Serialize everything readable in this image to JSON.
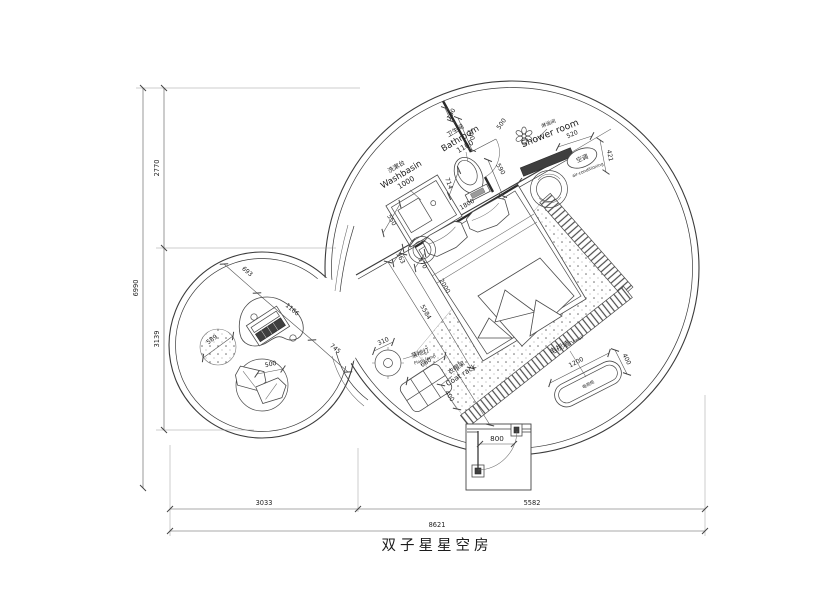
{
  "title": "双子星星空房",
  "labels": {
    "washbasin": {
      "cn": "洗漱台",
      "en": "Washbasin",
      "width": "1000"
    },
    "bathroom": {
      "cn": "卫生间",
      "en": "Bathroom",
      "width": "1100"
    },
    "shower_room": {
      "cn": "淋浴间",
      "en": "Shower room"
    },
    "air_conditioning": {
      "cn": "空调",
      "en": "air-conditioning"
    },
    "floor_lamp": {
      "cn": "落地灯",
      "en": "Floor lamp",
      "diameter": "310"
    },
    "coat_rack": {
      "cn": "衣帽架",
      "en": "Coat rack",
      "width": "660",
      "depth": "400"
    },
    "tv_wall": {
      "cn": "电视墙",
      "en": "TV wall",
      "width": "1200",
      "depth": "400"
    },
    "tv_cabinet": {
      "cn": "电视柜"
    }
  },
  "dims": {
    "bath_zone": {
      "a": "190",
      "b": "700",
      "door": "500",
      "c": "590",
      "d": "520",
      "e": "421",
      "toilet": "714",
      "counter_side": "550"
    },
    "bed_zone": {
      "headboard": "1800",
      "stool_a": "363",
      "stool_b": "570",
      "length": "2000",
      "diag": "5584"
    },
    "lounge": {
      "a": "693",
      "b": "1166",
      "c": "745",
      "rug": "589",
      "cushion": "500"
    },
    "entry": {
      "door": "800"
    }
  },
  "overall": {
    "left": {
      "total": "6990",
      "top": "2770",
      "bottom": "3139"
    },
    "bottom": {
      "total": "8621",
      "left": "3033",
      "right": "5582"
    }
  }
}
